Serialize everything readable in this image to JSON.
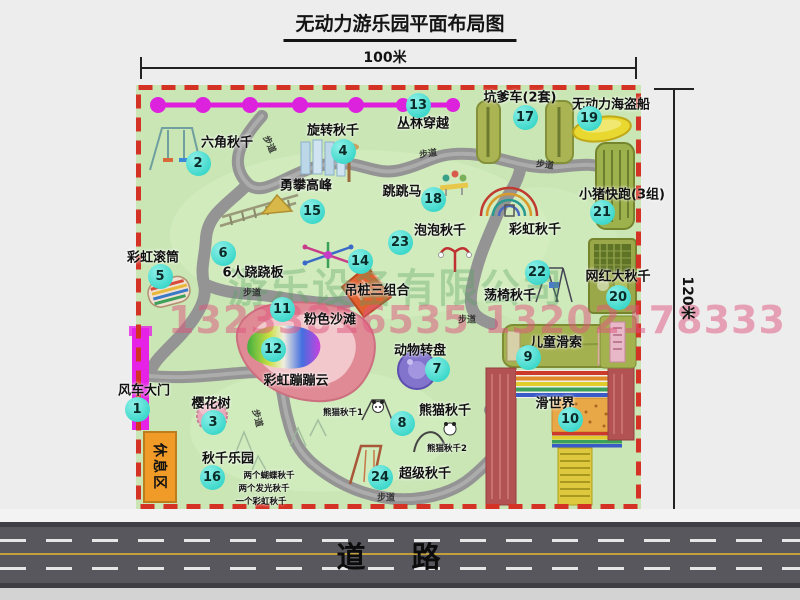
{
  "title": "无动力游乐园平面布局图",
  "dimensions": {
    "width": "100米",
    "height": "120米"
  },
  "road": {
    "label": "道路"
  },
  "watermark": {
    "company": "游乐设备有限公司",
    "phone": "13233816535 13202178333"
  },
  "rest_area": {
    "label": "休息区"
  },
  "colors": {
    "page_bg": "#ededed",
    "map_bg": "#c9e6b4",
    "map_border": "#d43224",
    "badge": "#3ed8cb",
    "chain": "#de1edc",
    "gate": "#e622e6",
    "path": "#949494",
    "road_bg": "#57575d",
    "road_edge": "#3e3e44",
    "road_white": "#e6e6e6",
    "road_yellow": "#c2a13c",
    "rest_bg": "#f09a28",
    "wm_green": "#55a060",
    "wm_pink": "#e0557e"
  },
  "map": {
    "attractions": [
      {
        "num": "1",
        "label": "风车大门",
        "label_x": 144,
        "label_y": 389,
        "badge_x": 137,
        "badge_y": 409
      },
      {
        "num": "2",
        "label": "六角秋千",
        "label_x": 227,
        "label_y": 141,
        "badge_x": 198,
        "badge_y": 163
      },
      {
        "num": "3",
        "label": "樱花树",
        "label_x": 211,
        "label_y": 402,
        "badge_x": 213,
        "badge_y": 422
      },
      {
        "num": "4",
        "label": "旋转秋千",
        "label_x": 333,
        "label_y": 129,
        "badge_x": 343,
        "badge_y": 151
      },
      {
        "num": "5",
        "label": "彩虹滚筒",
        "label_x": 153,
        "label_y": 256,
        "badge_x": 160,
        "badge_y": 276
      },
      {
        "num": "6",
        "label": "6人跷跷板",
        "label_x": 253,
        "label_y": 271,
        "badge_x": 223,
        "badge_y": 253
      },
      {
        "num": "7",
        "label": "动物转盘",
        "label_x": 420,
        "label_y": 349,
        "badge_x": 437,
        "badge_y": 369
      },
      {
        "num": "8",
        "label": "熊猫秋千",
        "label_x": 445,
        "label_y": 409,
        "badge_x": 402,
        "badge_y": 423
      },
      {
        "num": "9",
        "label": "儿童滑索",
        "label_x": 556,
        "label_y": 341,
        "badge_x": 528,
        "badge_y": 357
      },
      {
        "num": "10",
        "label": "滑世界",
        "label_x": 555,
        "label_y": 402,
        "badge_x": 570,
        "badge_y": 419
      },
      {
        "num": "11",
        "label": "粉色沙滩",
        "label_x": 330,
        "label_y": 318,
        "badge_x": 282,
        "badge_y": 309
      },
      {
        "num": "12",
        "label": "彩虹蹦蹦云",
        "label_x": 296,
        "label_y": 379,
        "badge_x": 273,
        "badge_y": 349
      },
      {
        "num": "13",
        "label": "丛林穿越",
        "label_x": 423,
        "label_y": 122,
        "badge_x": 418,
        "badge_y": 105
      },
      {
        "num": "14",
        "label": "吊桩三组合",
        "label_x": 377,
        "label_y": 289,
        "badge_x": 360,
        "badge_y": 261
      },
      {
        "num": "15",
        "label": "勇攀高峰",
        "label_x": 306,
        "label_y": 184,
        "badge_x": 312,
        "badge_y": 211
      },
      {
        "num": "16",
        "label": "秋千乐园",
        "label_x": 228,
        "label_y": 457,
        "badge_x": 212,
        "badge_y": 477
      },
      {
        "num": "17",
        "label": "坑爹车(2套)",
        "label_x": 520,
        "label_y": 96,
        "badge_x": 525,
        "badge_y": 117
      },
      {
        "num": "18",
        "label": "跳跳马",
        "label_x": 402,
        "label_y": 190,
        "badge_x": 433,
        "badge_y": 199
      },
      {
        "num": "19",
        "label": "无动力海盗船",
        "label_x": 611,
        "label_y": 103,
        "badge_x": 589,
        "badge_y": 118
      },
      {
        "num": "20",
        "label": "网红大秋千",
        "label_x": 618,
        "label_y": 275,
        "badge_x": 618,
        "badge_y": 297
      },
      {
        "num": "21",
        "label": "小猪快跑(3组)",
        "label_x": 622,
        "label_y": 193,
        "badge_x": 602,
        "badge_y": 212
      },
      {
        "num": "22",
        "label": "荡椅秋千",
        "label_x": 510,
        "label_y": 294,
        "badge_x": 537,
        "badge_y": 272
      },
      {
        "num": "23",
        "label": "泡泡秋千",
        "label_x": 440,
        "label_y": 229,
        "badge_x": 400,
        "badge_y": 242
      },
      {
        "num": "24",
        "label": "超级秋千",
        "label_x": 425,
        "label_y": 472,
        "badge_x": 380,
        "badge_y": 477
      }
    ],
    "extra_labels": [
      {
        "name": "rainbow-swing-label",
        "text": "彩虹秋千",
        "x": 535,
        "y": 228
      }
    ],
    "sub_labels": [
      {
        "text": "熊猫秋千1",
        "x": 343,
        "y": 412
      },
      {
        "text": "熊猫秋千2",
        "x": 447,
        "y": 448
      },
      {
        "text": "两个蝴蝶秋千",
        "x": 269,
        "y": 475
      },
      {
        "text": "两个发光秋千",
        "x": 264,
        "y": 488
      },
      {
        "text": "一个彩虹秋千",
        "x": 261,
        "y": 501
      }
    ],
    "path_labels": [
      {
        "text": "步道",
        "x": 270,
        "y": 144,
        "rot": 65
      },
      {
        "text": "步道",
        "x": 428,
        "y": 153,
        "rot": -8
      },
      {
        "text": "步道",
        "x": 545,
        "y": 164,
        "rot": 8
      },
      {
        "text": "步道",
        "x": 252,
        "y": 292,
        "rot": 0
      },
      {
        "text": "步道",
        "x": 467,
        "y": 319,
        "rot": 0
      },
      {
        "text": "步道",
        "x": 258,
        "y": 418,
        "rot": 75
      },
      {
        "text": "步道",
        "x": 386,
        "y": 497,
        "rot": 0
      }
    ]
  }
}
